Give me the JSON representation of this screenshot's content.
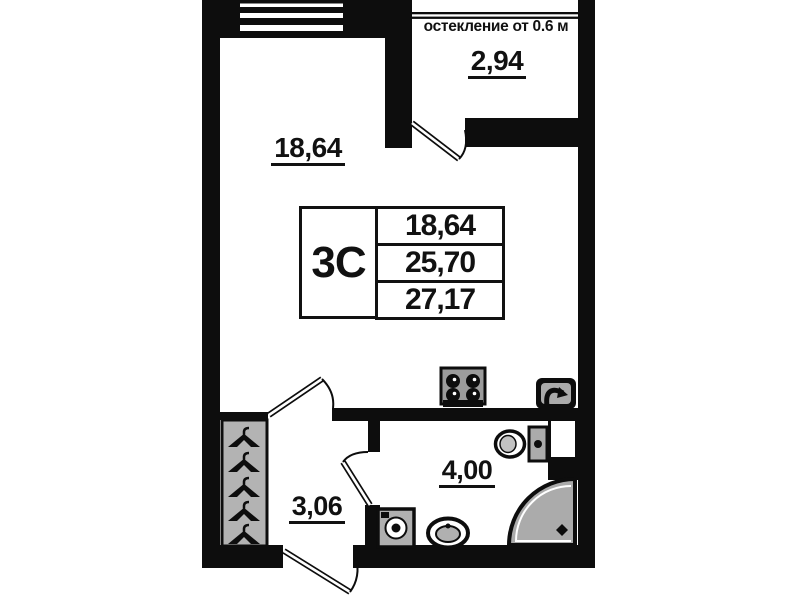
{
  "glazing_note": "остекление от 0.6 м",
  "rooms": {
    "living": {
      "area": "18,64"
    },
    "balcony": {
      "area": "2,94"
    },
    "hallway": {
      "area": "3,06"
    },
    "bathroom": {
      "area": "4,00"
    }
  },
  "spec_table": {
    "type": "3С",
    "rows": [
      "18,64",
      "25,70",
      "27,17"
    ]
  },
  "icons": [
    "window-icon",
    "balcony-door-icon",
    "room-door-icon",
    "bathroom-door-icon",
    "entrance-door-icon",
    "stove-icon",
    "kitchen-sink-icon",
    "toilet-icon",
    "shower-icon",
    "washing-machine-icon",
    "bathroom-sink-icon",
    "wardrobe-icon",
    "hanger-icon"
  ],
  "colors": {
    "wall": "#0d0d0d",
    "fixture_gray": "#aeaeae",
    "background": "#ffffff"
  }
}
